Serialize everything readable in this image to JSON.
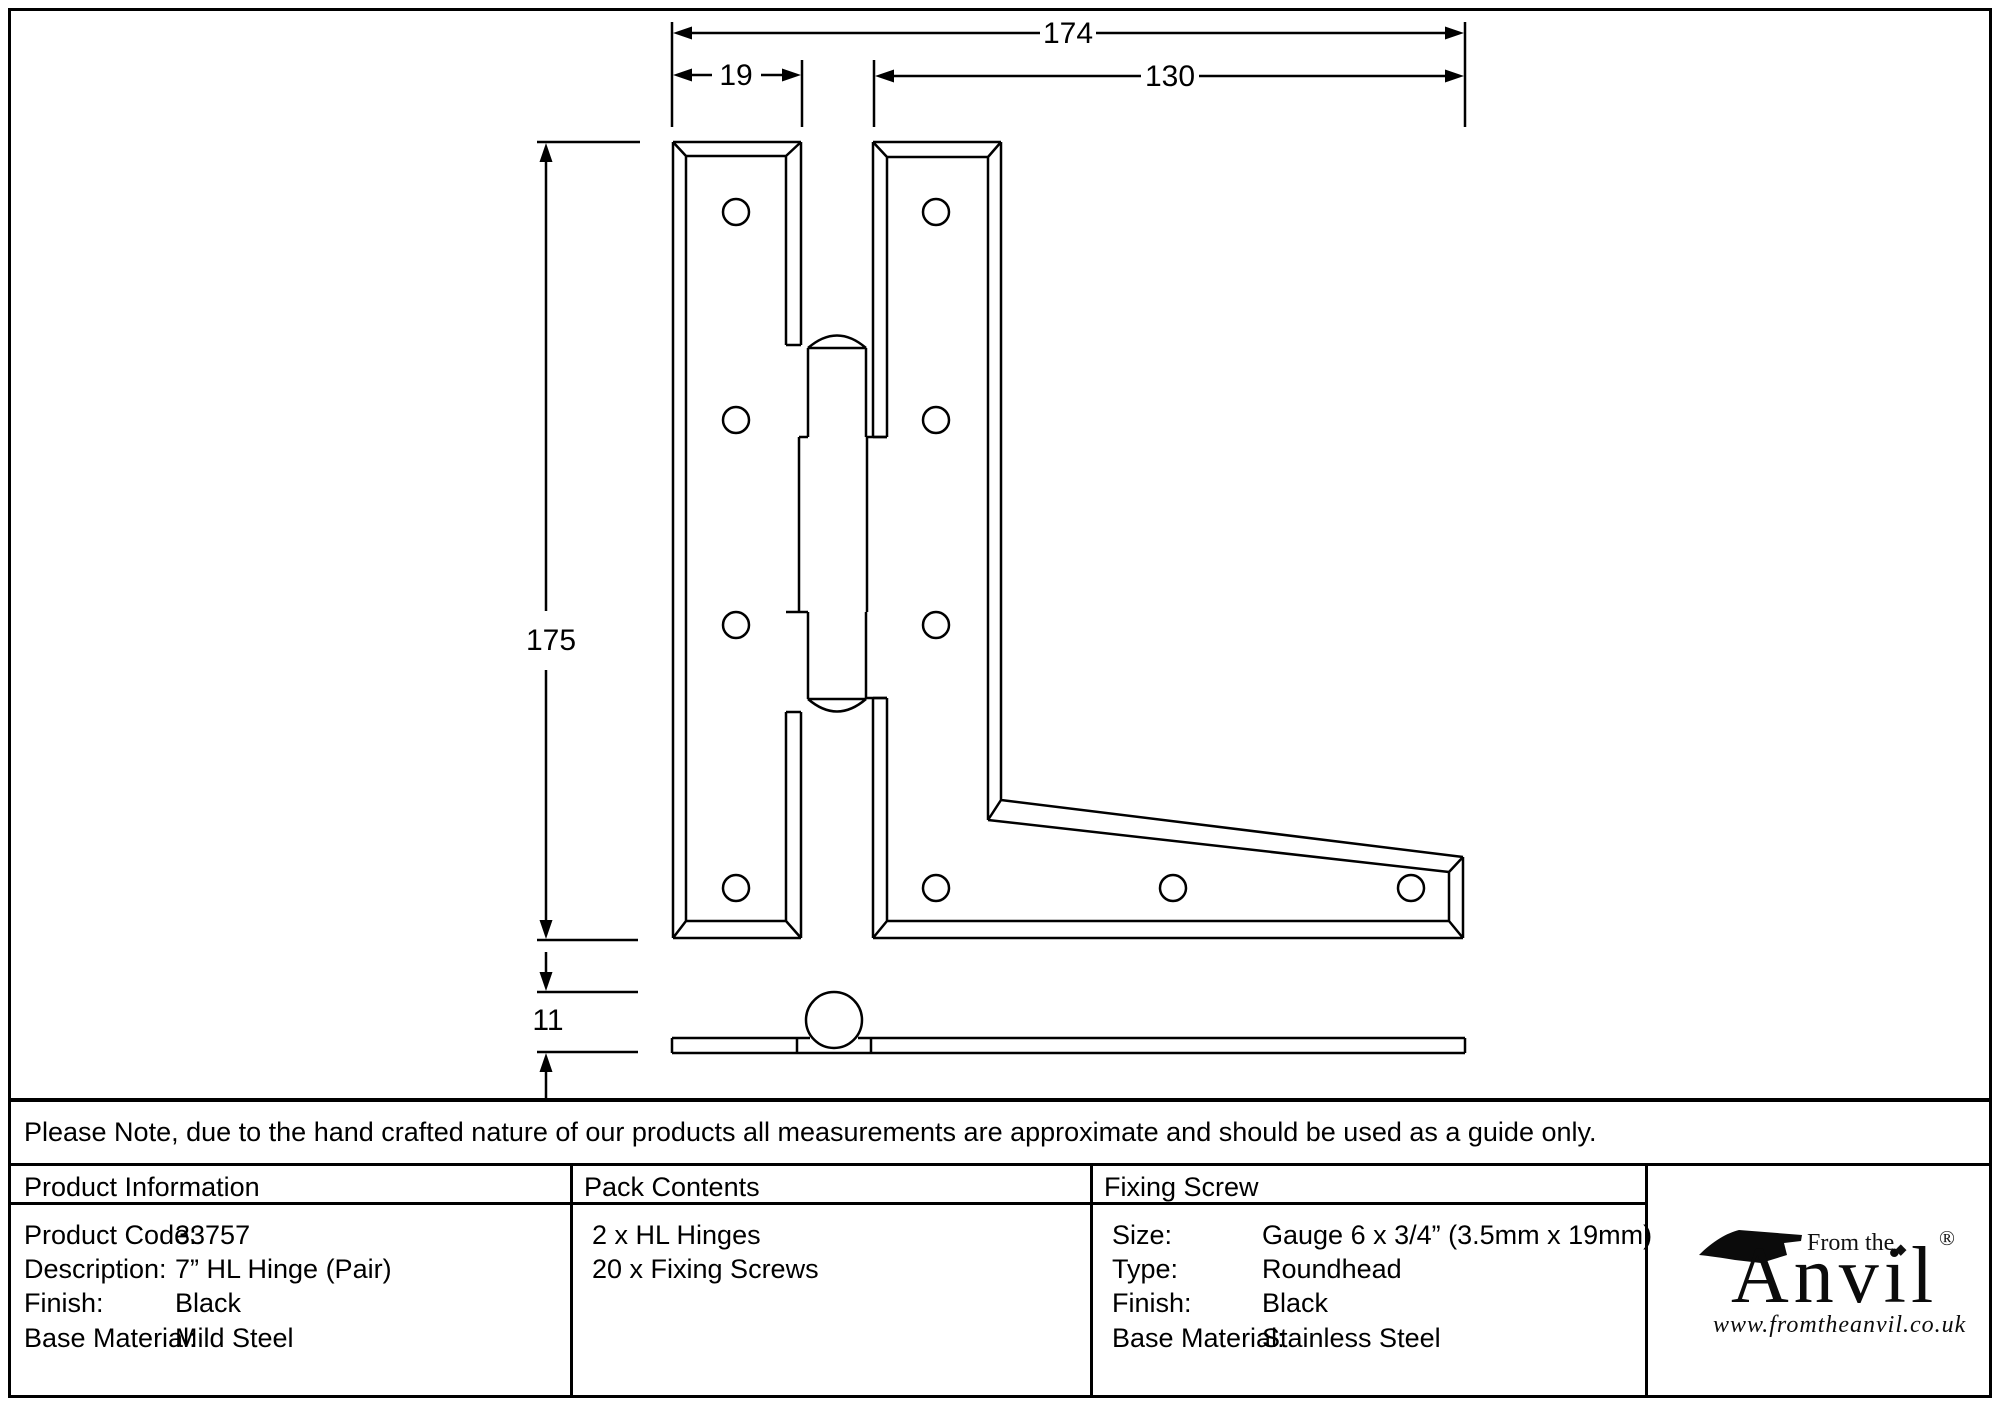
{
  "drawing": {
    "dim_overall_width": "174",
    "dim_leaf_width": "19",
    "dim_arm_length": "130",
    "dim_height": "175",
    "dim_thickness": "11"
  },
  "note": "Please Note, due to the hand crafted nature of our products all measurements are approximate and should be used as a guide only.",
  "table": {
    "product_information": {
      "header": "Product Information",
      "rows": [
        {
          "label": "Product Code:",
          "value": "33757"
        },
        {
          "label": "Description:",
          "value": "7” HL Hinge (Pair)"
        },
        {
          "label": "Finish:",
          "value": "Black"
        },
        {
          "label": "Base Material:",
          "value": "Mild Steel"
        }
      ]
    },
    "pack_contents": {
      "header": "Pack Contents",
      "lines": [
        "2 x HL Hinges",
        "20 x Fixing Screws"
      ]
    },
    "fixing_screw": {
      "header": "Fixing Screw",
      "rows": [
        {
          "label": "Size:",
          "value": "Gauge 6 x 3/4” (3.5mm x 19mm)"
        },
        {
          "label": "Type:",
          "value": "Roundhead"
        },
        {
          "label": "Finish:",
          "value": "Black"
        },
        {
          "label": "Base Material:",
          "value": "Stainless Steel"
        }
      ]
    }
  },
  "logo": {
    "tagline": "From the",
    "brand": "Anvil",
    "registered": "®",
    "diamond": "◆",
    "url": "www.fromtheanvil.co.uk"
  },
  "colors": {
    "line": "#000000",
    "background": "#ffffff"
  }
}
